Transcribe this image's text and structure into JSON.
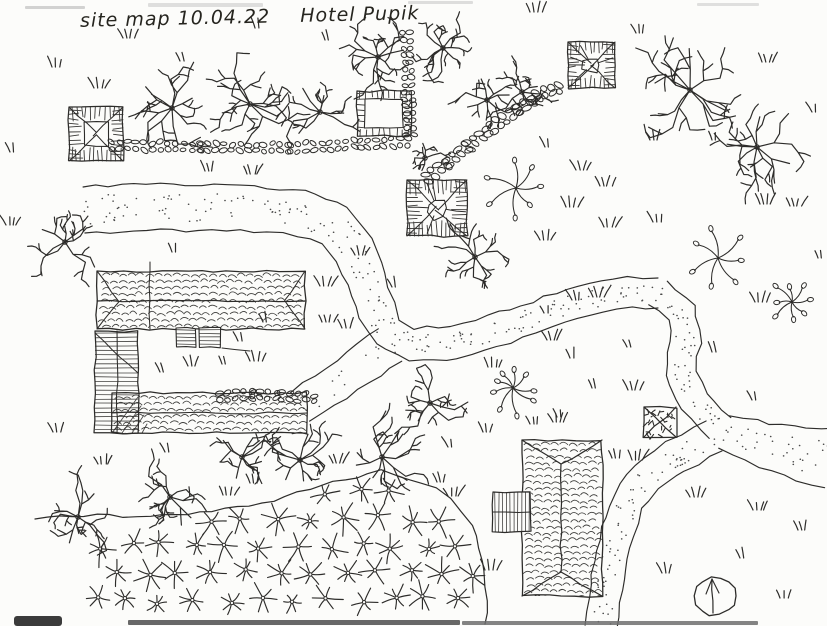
{
  "title": {
    "left": "site map 10.04.22",
    "right": "Hotel Pupik"
  },
  "palette": {
    "ink": "#2d2c2a",
    "stipple": "#4a4a4a",
    "paper": "#fcfcfa"
  },
  "canvas": {
    "w": 827,
    "h": 626
  },
  "roads": [
    {
      "name": "west-road",
      "pts": [
        [
          84,
          210
        ],
        [
          160,
          207
        ],
        [
          240,
          208
        ],
        [
          300,
          213
        ],
        [
          335,
          225
        ],
        [
          355,
          250
        ],
        [
          366,
          280
        ],
        [
          376,
          310
        ],
        [
          388,
          332
        ],
        [
          412,
          345
        ],
        [
          455,
          342
        ],
        [
          505,
          328
        ],
        [
          560,
          308
        ],
        [
          615,
          293
        ],
        [
          658,
          293
        ]
      ],
      "w": [
        46,
        46,
        46,
        45,
        44,
        42,
        40,
        38,
        36,
        34,
        33,
        32,
        31,
        30,
        30
      ],
      "dots": 0.3
    },
    {
      "name": "east-descent",
      "pts": [
        [
          658,
          293
        ],
        [
          682,
          312
        ],
        [
          686,
          342
        ],
        [
          680,
          372
        ],
        [
          695,
          402
        ],
        [
          720,
          428
        ]
      ],
      "w": 30,
      "dots": 0.3
    },
    {
      "name": "east-branch",
      "pts": [
        [
          724,
          432
        ],
        [
          764,
          445
        ],
        [
          802,
          454
        ],
        [
          829,
          458
        ]
      ],
      "w": [
        34,
        46,
        54,
        60
      ],
      "dots": 0.3
    },
    {
      "name": "south-branch",
      "pts": [
        [
          714,
          436
        ],
        [
          676,
          456
        ],
        [
          646,
          478
        ],
        [
          628,
          502
        ],
        [
          618,
          532
        ],
        [
          610,
          565
        ],
        [
          604,
          600
        ],
        [
          601,
          627
        ]
      ],
      "w": [
        34,
        34,
        33,
        33,
        32,
        32,
        32,
        32
      ],
      "dots": 0.3
    },
    {
      "name": "southwest-stub",
      "pts": [
        [
          390,
          345
        ],
        [
          358,
          368
        ],
        [
          325,
          390
        ],
        [
          300,
          407
        ]
      ],
      "w": [
        40,
        38,
        36,
        34
      ],
      "dots": 0.12
    }
  ],
  "cobbles": [
    {
      "pts": [
        [
          112,
          145
        ],
        [
          200,
          147
        ],
        [
          290,
          148
        ],
        [
          360,
          144
        ],
        [
          413,
          141
        ]
      ],
      "rows": 2,
      "step": 8
    },
    {
      "pts": [
        [
          406,
          33
        ],
        [
          408,
          70
        ],
        [
          409,
          105
        ],
        [
          410,
          138
        ]
      ],
      "rows": 2,
      "step": 7.5
    },
    {
      "pts": [
        [
          427,
          178
        ],
        [
          447,
          162
        ],
        [
          468,
          146
        ],
        [
          492,
          128
        ],
        [
          518,
          109
        ],
        [
          544,
          92
        ],
        [
          564,
          87
        ]
      ],
      "rows": 2,
      "step": 8,
      "size": 1.2
    },
    {
      "pts": [
        [
          220,
          396
        ],
        [
          252,
          394
        ],
        [
          282,
          396
        ],
        [
          315,
          398
        ]
      ],
      "rows": 2,
      "step": 8
    }
  ],
  "canopy_squares": [
    {
      "x": 69,
      "y": 107,
      "w": 54,
      "h": 54,
      "style": "square"
    },
    {
      "x": 568,
      "y": 42,
      "w": 47,
      "h": 46,
      "style": "poly"
    },
    {
      "x": 407,
      "y": 180,
      "w": 60,
      "h": 56,
      "style": "poly"
    },
    {
      "x": 644,
      "y": 407,
      "w": 32,
      "h": 30,
      "style": "dark"
    }
  ],
  "stone_planter": {
    "x": 357,
    "y": 91,
    "w": 54,
    "h": 45,
    "inset": 8
  },
  "main_building": {
    "north": {
      "x": 97,
      "y": 271,
      "w": 208,
      "h": 58,
      "ridge": 301,
      "div": 150
    },
    "west": {
      "x": 95,
      "y": 331,
      "w": 43,
      "h": 102,
      "div": 117
    },
    "south": {
      "x": 112,
      "y": 393,
      "w": 195,
      "h": 40,
      "ridge": 413
    },
    "porches": [
      [
        176,
        328,
        20,
        19
      ],
      [
        199,
        328,
        22,
        19
      ]
    ]
  },
  "south_building": {
    "x": 522,
    "y": 440,
    "w": 80,
    "h": 156,
    "ridge": 561,
    "hip": 24
  },
  "annex": {
    "x": 493,
    "y": 492,
    "w": 38,
    "h": 40,
    "div": 512
  },
  "trees": [
    [
      65,
      242,
      28,
      7
    ],
    [
      172,
      108,
      36,
      9
    ],
    [
      250,
      104,
      34,
      9
    ],
    [
      320,
      112,
      28,
      8
    ],
    [
      378,
      57,
      28,
      8
    ],
    [
      443,
      48,
      26,
      8
    ],
    [
      487,
      100,
      24,
      7
    ],
    [
      522,
      92,
      24,
      7
    ],
    [
      425,
      158,
      16,
      6
    ],
    [
      690,
      90,
      40,
      10
    ],
    [
      757,
      147,
      38,
      9
    ],
    [
      475,
      257,
      25,
      7
    ],
    [
      430,
      403,
      27,
      7
    ],
    [
      242,
      457,
      32,
      8
    ],
    [
      300,
      460,
      29,
      8
    ],
    [
      382,
      457,
      30,
      8
    ],
    [
      78,
      517,
      29,
      8
    ],
    [
      170,
      497,
      29,
      8
    ]
  ],
  "seed_plants": [
    [
      516,
      188,
      26
    ],
    [
      718,
      258,
      25
    ],
    [
      792,
      302,
      20
    ],
    [
      513,
      388,
      23
    ]
  ],
  "field": {
    "boundary": [
      [
        35,
        519
      ],
      [
        97,
        515
      ],
      [
        150,
        517
      ],
      [
        200,
        512
      ],
      [
        237,
        508
      ],
      [
        273,
        500
      ],
      [
        310,
        488
      ],
      [
        345,
        480
      ],
      [
        380,
        471
      ],
      [
        400,
        477
      ],
      [
        420,
        482
      ],
      [
        437,
        489
      ],
      [
        450,
        498
      ],
      [
        462,
        510
      ],
      [
        471,
        526
      ],
      [
        479,
        548
      ],
      [
        484,
        572
      ],
      [
        487,
        600
      ],
      [
        485,
        624
      ]
    ],
    "close": [
      [
        482,
        627
      ],
      [
        92,
        627
      ],
      [
        92,
        560
      ],
      [
        60,
        532
      ],
      [
        38,
        521
      ]
    ],
    "grid": {
      "x0": 96,
      "x1": 486,
      "dx": 33,
      "y0": 492,
      "y1": 622,
      "dy": 27
    }
  },
  "tufts": [
    [
      123,
      38
    ],
    [
      180,
      61
    ],
    [
      52,
      67
    ],
    [
      94,
      88
    ],
    [
      325,
      40
    ],
    [
      530,
      12
    ],
    [
      636,
      33
    ],
    [
      762,
      62
    ],
    [
      812,
      112
    ],
    [
      255,
      28
    ],
    [
      205,
      171
    ],
    [
      247,
      174
    ],
    [
      172,
      252
    ],
    [
      355,
      255
    ],
    [
      320,
      286
    ],
    [
      392,
      287
    ],
    [
      238,
      341
    ],
    [
      263,
      322
    ],
    [
      322,
      322
    ],
    [
      342,
      328
    ],
    [
      160,
      372
    ],
    [
      188,
      366
    ],
    [
      222,
      364
    ],
    [
      250,
      361
    ],
    [
      545,
      147
    ],
    [
      576,
      170
    ],
    [
      600,
      186
    ],
    [
      566,
      207
    ],
    [
      604,
      227
    ],
    [
      540,
      240
    ],
    [
      712,
      140
    ],
    [
      650,
      140
    ],
    [
      653,
      222
    ],
    [
      760,
      204
    ],
    [
      790,
      206
    ],
    [
      818,
      258
    ],
    [
      755,
      302
    ],
    [
      712,
      352
    ],
    [
      752,
      400
    ],
    [
      628,
      390
    ],
    [
      544,
      313
    ],
    [
      547,
      340
    ],
    [
      572,
      300
    ],
    [
      593,
      297
    ],
    [
      627,
      347
    ],
    [
      570,
      358
    ],
    [
      592,
      388
    ],
    [
      488,
      367
    ],
    [
      557,
      417
    ],
    [
      632,
      460
    ],
    [
      690,
      497
    ],
    [
      753,
      510
    ],
    [
      798,
      530
    ],
    [
      740,
      558
    ],
    [
      662,
      573
    ],
    [
      780,
      598
    ],
    [
      53,
      432
    ],
    [
      98,
      464
    ],
    [
      165,
      452
    ],
    [
      223,
      495
    ],
    [
      250,
      483
    ],
    [
      437,
      482
    ],
    [
      448,
      496
    ],
    [
      485,
      570
    ],
    [
      530,
      424
    ],
    [
      448,
      447
    ],
    [
      333,
      463
    ],
    [
      553,
      422
    ],
    [
      483,
      432
    ],
    [
      612,
      458
    ],
    [
      10,
      152
    ],
    [
      6,
      225
    ]
  ],
  "compass": {
    "cx": 715,
    "cy": 596,
    "rx": 21,
    "ry": 19
  },
  "artifacts": [
    {
      "x": 25,
      "y": 6,
      "w": 60,
      "h": 3,
      "c": "#b6b6b6",
      "o": 0.6
    },
    {
      "x": 148,
      "y": 3,
      "w": 115,
      "h": 4,
      "c": "#c0c0c0",
      "o": 0.5
    },
    {
      "x": 408,
      "y": 1,
      "w": 65,
      "h": 3,
      "c": "#bdbdbd",
      "o": 0.5
    },
    {
      "x": 697,
      "y": 3,
      "w": 62,
      "h": 3,
      "c": "#c2c2c2",
      "o": 0.5
    },
    {
      "x": 128,
      "y": 620,
      "w": 332,
      "h": 5,
      "c": "#585858",
      "o": 0.9
    },
    {
      "x": 462,
      "y": 621,
      "w": 296,
      "h": 4,
      "c": "#6e6e6e",
      "o": 0.85
    },
    {
      "x": 14,
      "y": 616,
      "w": 48,
      "h": 10,
      "c": "#303030",
      "o": 0.95,
      "r": 3
    }
  ]
}
